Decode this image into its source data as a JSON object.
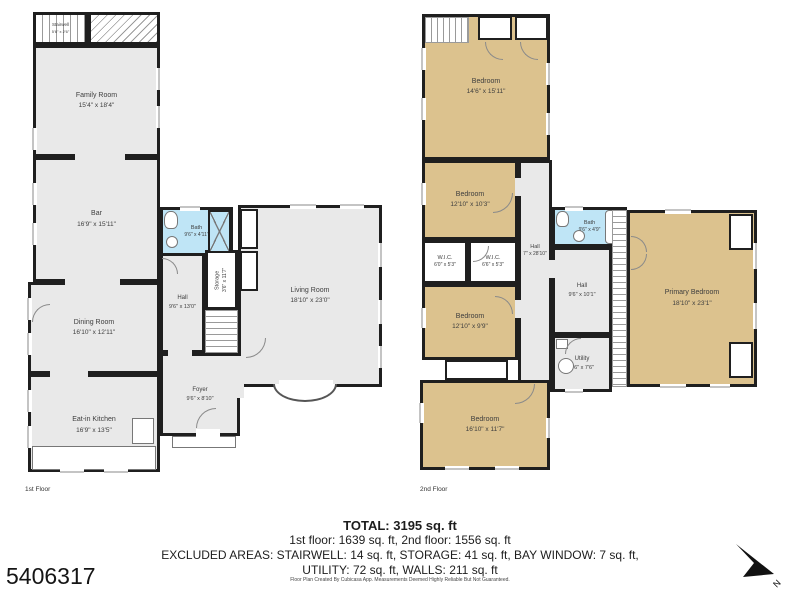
{
  "palette": {
    "wall": "#1f1f1f",
    "room_fill": "#e9e9e9",
    "bedroom_fill": "#dcc28e",
    "bath_fill": "#bfe5f6"
  },
  "plan_number": "5406317",
  "compass_label": "N",
  "floor1": {
    "label": "1st Floor",
    "rooms": [
      {
        "name": "Stairwell",
        "dims": "5'6\" x 2'6\""
      },
      {
        "name": "Family Room",
        "dims": "15'4\" x 18'4\""
      },
      {
        "name": "Bar",
        "dims": "16'9\" x 15'11\""
      },
      {
        "name": "Bath",
        "dims": "9'6\" x 4'11\""
      },
      {
        "name": "Storage",
        "dims": "3'6\" x 11'7\""
      },
      {
        "name": "Hall",
        "dims": "9'6\" x 13'0\""
      },
      {
        "name": "Dining Room",
        "dims": "16'10\" x 12'11\""
      },
      {
        "name": "Foyer",
        "dims": "9'6\" x 8'10\""
      },
      {
        "name": "Eat-in Kitchen",
        "dims": "16'9\" x 13'5\""
      },
      {
        "name": "Living Room",
        "dims": "18'10\" x 23'0\""
      }
    ]
  },
  "floor2": {
    "label": "2nd Floor",
    "rooms": [
      {
        "name": "Bedroom",
        "dims": "14'6\" x 15'11\""
      },
      {
        "name": "Bedroom",
        "dims": "12'10\" x 10'3\""
      },
      {
        "name": "W.I.C.",
        "dims": "6'0\" x 5'3\""
      },
      {
        "name": "W.I.C.",
        "dims": "6'6\" x 5'3\""
      },
      {
        "name": "Hall",
        "dims": "7\" x 28'10\""
      },
      {
        "name": "Bath",
        "dims": "9'6\" x 4'9\""
      },
      {
        "name": "Hall",
        "dims": "9'6\" x 10'1\""
      },
      {
        "name": "Bedroom",
        "dims": "12'10\" x 9'9\""
      },
      {
        "name": "Utility",
        "dims": "9'6\" x 7'6\""
      },
      {
        "name": "Primary Bedroom",
        "dims": "18'10\" x 23'1\""
      },
      {
        "name": "Bedroom",
        "dims": "16'10\" x 11'7\""
      }
    ]
  },
  "summary": {
    "total": "TOTAL: 3195 sq. ft",
    "floors": "1st floor: 1639 sq. ft, 2nd floor: 1556 sq. ft",
    "excluded_line1": "EXCLUDED AREAS: STAIRWELL: 14 sq. ft, STORAGE: 41 sq. ft, BAY WINDOW: 7 sq. ft,",
    "excluded_line2": "UTILITY: 72 sq. ft, WALLS: 211 sq. ft",
    "disclaimer": "Floor Plan Created By Cubicasa App. Measurements Deemed Highly Reliable But Not Guaranteed."
  }
}
